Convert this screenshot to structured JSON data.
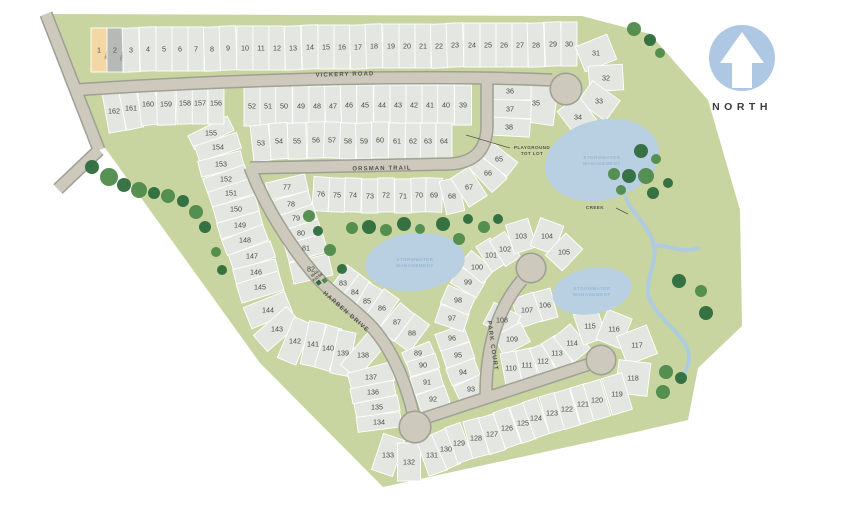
{
  "title": "Subdivision site plan",
  "north_label": "NORTH",
  "roads": [
    {
      "id": "vickery",
      "label": "VICKERY ROAD"
    },
    {
      "id": "orsman",
      "label": "ORSMAN TRAIL"
    },
    {
      "id": "harben",
      "label": "HARBEN DRIVE"
    },
    {
      "id": "park",
      "label": "PARK COURT"
    }
  ],
  "annotations": {
    "playground_line1": "PLAYGROUND",
    "playground_line2": "TOT LOT",
    "creek": "CREEK",
    "stormwater_line1": "STORMWATER",
    "stormwater_line2": "MANAGEMENT",
    "mail_line1": "MAIL",
    "mail_line2": "KIOSK"
  },
  "colors": {
    "site_green": "#c8d5a1",
    "lot_fill": "#e4e6e1",
    "lot_stroke": "#ffffff",
    "road_fill": "#cdc9bc",
    "road_edge": "#a0a094",
    "pond_fill": "#b9cfe2",
    "pond_text": "#8badc9",
    "tree_dark": "#2e6d3c",
    "tree_light": "#4f8b4b",
    "number_text": "#4c4c43",
    "road_text": "#54544a",
    "north_circle": "#aec7e3",
    "north_text": "#3b3b3b",
    "lot1_fill": "#f3d7a4",
    "lot2_fill": "#b6b9b5"
  },
  "blocks": [
    {
      "id": "row-1-30",
      "depth": 44,
      "lots": [
        {
          "n": "1",
          "x": 99,
          "y": 50,
          "fill": "#f3d7a4",
          "tag": "MODEL"
        },
        {
          "n": "2",
          "x": 115,
          "y": 50,
          "fill": "#b6b9b5",
          "tag": "PENDING"
        },
        {
          "n": "3",
          "x": 131,
          "y": 50
        },
        {
          "n": "4",
          "x": 148,
          "y": 49
        },
        {
          "n": "5",
          "x": 164,
          "y": 49
        },
        {
          "n": "6",
          "x": 180,
          "y": 49
        },
        {
          "n": "7",
          "x": 196,
          "y": 49
        },
        {
          "n": "8",
          "x": 212,
          "y": 49
        },
        {
          "n": "9",
          "x": 228,
          "y": 48
        },
        {
          "n": "10",
          "x": 245,
          "y": 48
        },
        {
          "n": "11",
          "x": 261,
          "y": 48
        },
        {
          "n": "12",
          "x": 277,
          "y": 48
        },
        {
          "n": "13",
          "x": 293,
          "y": 48
        },
        {
          "n": "14",
          "x": 310,
          "y": 47
        },
        {
          "n": "15",
          "x": 326,
          "y": 47
        },
        {
          "n": "16",
          "x": 342,
          "y": 47
        },
        {
          "n": "17",
          "x": 358,
          "y": 47
        },
        {
          "n": "18",
          "x": 374,
          "y": 46
        },
        {
          "n": "19",
          "x": 391,
          "y": 46
        },
        {
          "n": "20",
          "x": 407,
          "y": 46
        },
        {
          "n": "21",
          "x": 423,
          "y": 46
        },
        {
          "n": "22",
          "x": 439,
          "y": 46
        },
        {
          "n": "23",
          "x": 455,
          "y": 45
        },
        {
          "n": "24",
          "x": 472,
          "y": 45
        },
        {
          "n": "25",
          "x": 488,
          "y": 45
        },
        {
          "n": "26",
          "x": 504,
          "y": 45
        },
        {
          "n": "27",
          "x": 520,
          "y": 45
        },
        {
          "n": "28",
          "x": 536,
          "y": 45
        },
        {
          "n": "29",
          "x": 553,
          "y": 44
        },
        {
          "n": "30",
          "x": 569,
          "y": 44
        }
      ]
    },
    {
      "id": "fan-31-34",
      "depth": 34,
      "lots": [
        {
          "n": "31",
          "x": 596,
          "y": 53
        },
        {
          "n": "32",
          "x": 606,
          "y": 78
        },
        {
          "n": "33",
          "x": 599,
          "y": 101
        },
        {
          "n": "34",
          "x": 578,
          "y": 117
        }
      ]
    },
    {
      "id": "lot-35",
      "depth": 40,
      "rot": 8,
      "lots": [
        {
          "n": "35",
          "x": 536,
          "y": 103
        }
      ]
    },
    {
      "id": "col-36-38",
      "depth": 42,
      "lots": [
        {
          "n": "36",
          "x": 510,
          "y": 91
        },
        {
          "n": "37",
          "x": 510,
          "y": 109
        },
        {
          "n": "38",
          "x": 509,
          "y": 127
        }
      ]
    },
    {
      "id": "row-39-52",
      "depth": 40,
      "lots": [
        {
          "n": "52",
          "x": 252,
          "y": 106
        },
        {
          "n": "51",
          "x": 268,
          "y": 106
        },
        {
          "n": "50",
          "x": 284,
          "y": 106
        },
        {
          "n": "49",
          "x": 301,
          "y": 106
        },
        {
          "n": "48",
          "x": 317,
          "y": 106
        },
        {
          "n": "47",
          "x": 333,
          "y": 106
        },
        {
          "n": "46",
          "x": 349,
          "y": 105
        },
        {
          "n": "45",
          "x": 365,
          "y": 105
        },
        {
          "n": "44",
          "x": 382,
          "y": 105
        },
        {
          "n": "43",
          "x": 398,
          "y": 105
        },
        {
          "n": "42",
          "x": 414,
          "y": 105
        },
        {
          "n": "41",
          "x": 430,
          "y": 105
        },
        {
          "n": "40",
          "x": 446,
          "y": 105
        },
        {
          "n": "39",
          "x": 463,
          "y": 105
        }
      ]
    },
    {
      "id": "row-53-64",
      "depth": 36,
      "lots": [
        {
          "n": "53",
          "x": 261,
          "y": 143
        },
        {
          "n": "54",
          "x": 279,
          "y": 141
        },
        {
          "n": "55",
          "x": 297,
          "y": 141
        },
        {
          "n": "56",
          "x": 316,
          "y": 140
        },
        {
          "n": "57",
          "x": 332,
          "y": 140
        },
        {
          "n": "58",
          "x": 348,
          "y": 141
        },
        {
          "n": "59",
          "x": 364,
          "y": 141
        },
        {
          "n": "60",
          "x": 380,
          "y": 140
        },
        {
          "n": "61",
          "x": 397,
          "y": 141
        },
        {
          "n": "62",
          "x": 413,
          "y": 141
        },
        {
          "n": "63",
          "x": 428,
          "y": 141
        },
        {
          "n": "64",
          "x": 444,
          "y": 141
        }
      ]
    },
    {
      "id": "row-65-76",
      "depth": 34,
      "lots": [
        {
          "n": "76",
          "x": 321,
          "y": 194
        },
        {
          "n": "75",
          "x": 337,
          "y": 195
        },
        {
          "n": "74",
          "x": 353,
          "y": 195
        },
        {
          "n": "73",
          "x": 370,
          "y": 196
        },
        {
          "n": "72",
          "x": 386,
          "y": 195
        },
        {
          "n": "71",
          "x": 403,
          "y": 196
        },
        {
          "n": "70",
          "x": 419,
          "y": 195
        },
        {
          "n": "69",
          "x": 434,
          "y": 195
        },
        {
          "n": "68",
          "x": 452,
          "y": 196
        },
        {
          "n": "67",
          "x": 469,
          "y": 187
        },
        {
          "n": "66",
          "x": 488,
          "y": 173
        },
        {
          "n": "65",
          "x": 499,
          "y": 159
        }
      ]
    },
    {
      "id": "col-77-82",
      "depth": 40,
      "lots": [
        {
          "n": "77",
          "x": 287,
          "y": 187
        },
        {
          "n": "78",
          "x": 291,
          "y": 204
        },
        {
          "n": "79",
          "x": 296,
          "y": 218
        },
        {
          "n": "80",
          "x": 301,
          "y": 233
        },
        {
          "n": "81",
          "x": 306,
          "y": 248
        },
        {
          "n": "82",
          "x": 311,
          "y": 269
        }
      ]
    },
    {
      "id": "col-83-88",
      "depth": 34,
      "lots": [
        {
          "n": "83",
          "x": 343,
          "y": 283
        },
        {
          "n": "84",
          "x": 355,
          "y": 292
        },
        {
          "n": "85",
          "x": 367,
          "y": 301
        },
        {
          "n": "86",
          "x": 382,
          "y": 308
        },
        {
          "n": "87",
          "x": 397,
          "y": 322
        },
        {
          "n": "88",
          "x": 412,
          "y": 333
        }
      ]
    },
    {
      "id": "col-89-92",
      "depth": 30,
      "lots": [
        {
          "n": "89",
          "x": 418,
          "y": 353
        },
        {
          "n": "90",
          "x": 423,
          "y": 365
        },
        {
          "n": "91",
          "x": 427,
          "y": 382
        },
        {
          "n": "92",
          "x": 433,
          "y": 399
        }
      ]
    },
    {
      "id": "col-93-96",
      "depth": 30,
      "lots": [
        {
          "n": "96",
          "x": 452,
          "y": 338
        },
        {
          "n": "95",
          "x": 458,
          "y": 355
        },
        {
          "n": "94",
          "x": 463,
          "y": 372
        },
        {
          "n": "93",
          "x": 471,
          "y": 389
        }
      ]
    },
    {
      "id": "arc-97-105",
      "depth": 30,
      "lots": [
        {
          "n": "97",
          "x": 452,
          "y": 318
        },
        {
          "n": "98",
          "x": 458,
          "y": 300
        },
        {
          "n": "99",
          "x": 468,
          "y": 282
        },
        {
          "n": "100",
          "x": 477,
          "y": 267
        },
        {
          "n": "101",
          "x": 491,
          "y": 255
        },
        {
          "n": "102",
          "x": 505,
          "y": 249
        },
        {
          "n": "103",
          "x": 521,
          "y": 236
        },
        {
          "n": "104",
          "x": 547,
          "y": 236
        },
        {
          "n": "105",
          "x": 564,
          "y": 252
        }
      ]
    },
    {
      "id": "col-106-109",
      "depth": 30,
      "lots": [
        {
          "n": "106",
          "x": 545,
          "y": 305
        },
        {
          "n": "107",
          "x": 527,
          "y": 310
        },
        {
          "n": "108",
          "x": 502,
          "y": 320
        },
        {
          "n": "109",
          "x": 512,
          "y": 339
        }
      ]
    },
    {
      "id": "ring-110-118",
      "depth": 32,
      "lots": [
        {
          "n": "110",
          "x": 511,
          "y": 368
        },
        {
          "n": "111",
          "x": 527,
          "y": 365
        },
        {
          "n": "112",
          "x": 543,
          "y": 361
        },
        {
          "n": "113",
          "x": 557,
          "y": 353
        },
        {
          "n": "114",
          "x": 572,
          "y": 343
        },
        {
          "n": "115",
          "x": 590,
          "y": 326
        },
        {
          "n": "116",
          "x": 614,
          "y": 329
        },
        {
          "n": "117",
          "x": 637,
          "y": 345
        },
        {
          "n": "118",
          "x": 633,
          "y": 378
        }
      ]
    },
    {
      "id": "row-119-133",
      "depth": 38,
      "lots": [
        {
          "n": "133",
          "x": 388,
          "y": 455
        },
        {
          "n": "132",
          "x": 409,
          "y": 462
        },
        {
          "n": "131",
          "x": 432,
          "y": 455
        },
        {
          "n": "130",
          "x": 446,
          "y": 449
        },
        {
          "n": "129",
          "x": 459,
          "y": 443
        },
        {
          "n": "128",
          "x": 476,
          "y": 438
        },
        {
          "n": "127",
          "x": 492,
          "y": 434
        },
        {
          "n": "126",
          "x": 507,
          "y": 428
        },
        {
          "n": "125",
          "x": 523,
          "y": 423
        },
        {
          "n": "124",
          "x": 536,
          "y": 418
        },
        {
          "n": "123",
          "x": 552,
          "y": 413
        },
        {
          "n": "122",
          "x": 567,
          "y": 409
        },
        {
          "n": "121",
          "x": 583,
          "y": 404
        },
        {
          "n": "120",
          "x": 597,
          "y": 400
        },
        {
          "n": "119",
          "x": 617,
          "y": 394
        }
      ]
    },
    {
      "id": "col-134-155",
      "depth": 44,
      "lots": [
        {
          "n": "155",
          "x": 211,
          "y": 133
        },
        {
          "n": "154",
          "x": 218,
          "y": 147
        },
        {
          "n": "153",
          "x": 221,
          "y": 164
        },
        {
          "n": "152",
          "x": 226,
          "y": 179
        },
        {
          "n": "151",
          "x": 231,
          "y": 193
        },
        {
          "n": "150",
          "x": 236,
          "y": 209
        },
        {
          "n": "149",
          "x": 240,
          "y": 225
        },
        {
          "n": "148",
          "x": 245,
          "y": 240
        },
        {
          "n": "147",
          "x": 252,
          "y": 256
        },
        {
          "n": "146",
          "x": 256,
          "y": 272
        },
        {
          "n": "145",
          "x": 260,
          "y": 287
        },
        {
          "n": "144",
          "x": 268,
          "y": 310
        },
        {
          "n": "143",
          "x": 277,
          "y": 329
        },
        {
          "n": "142",
          "x": 295,
          "y": 341
        },
        {
          "n": "141",
          "x": 313,
          "y": 344
        },
        {
          "n": "140",
          "x": 328,
          "y": 348
        },
        {
          "n": "139",
          "x": 343,
          "y": 353
        },
        {
          "n": "138",
          "x": 363,
          "y": 355
        },
        {
          "n": "137",
          "x": 371,
          "y": 377
        },
        {
          "n": "136",
          "x": 373,
          "y": 392
        },
        {
          "n": "135",
          "x": 377,
          "y": 407
        },
        {
          "n": "134",
          "x": 379,
          "y": 422
        }
      ]
    },
    {
      "id": "row-156-162",
      "depth": 42,
      "lots": [
        {
          "n": "162",
          "x": 114,
          "y": 111
        },
        {
          "n": "161",
          "x": 131,
          "y": 108
        },
        {
          "n": "160",
          "x": 148,
          "y": 104
        },
        {
          "n": "159",
          "x": 166,
          "y": 104
        },
        {
          "n": "158",
          "x": 185,
          "y": 103
        },
        {
          "n": "157",
          "x": 200,
          "y": 103
        },
        {
          "n": "156",
          "x": 216,
          "y": 103
        }
      ]
    }
  ]
}
